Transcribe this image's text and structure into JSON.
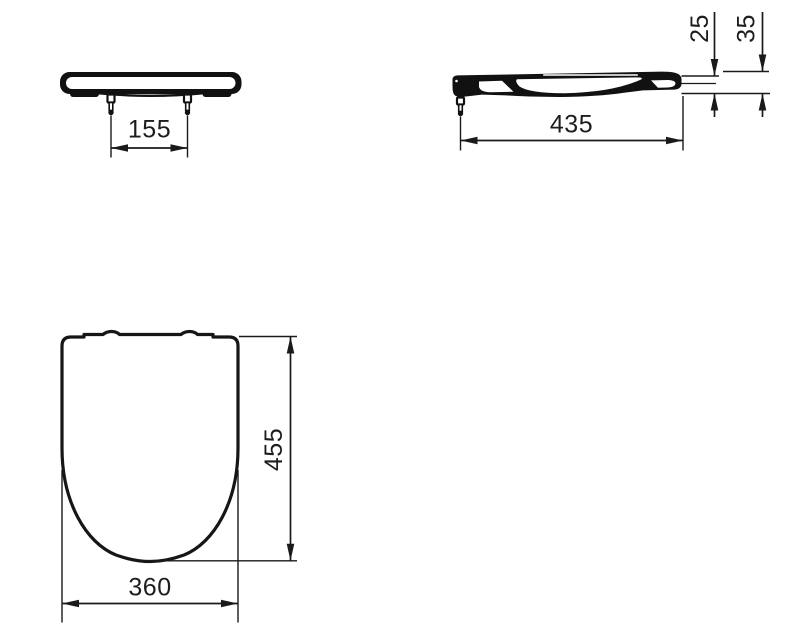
{
  "colors": {
    "line": "#1a1a1a",
    "silhouette": "#111111",
    "background": "#ffffff"
  },
  "views": {
    "front": {
      "hinge_spacing": "155"
    },
    "side": {
      "length": "435",
      "rear_height": "25",
      "overall_height": "35"
    },
    "plan": {
      "depth": "455",
      "width": "360"
    }
  }
}
